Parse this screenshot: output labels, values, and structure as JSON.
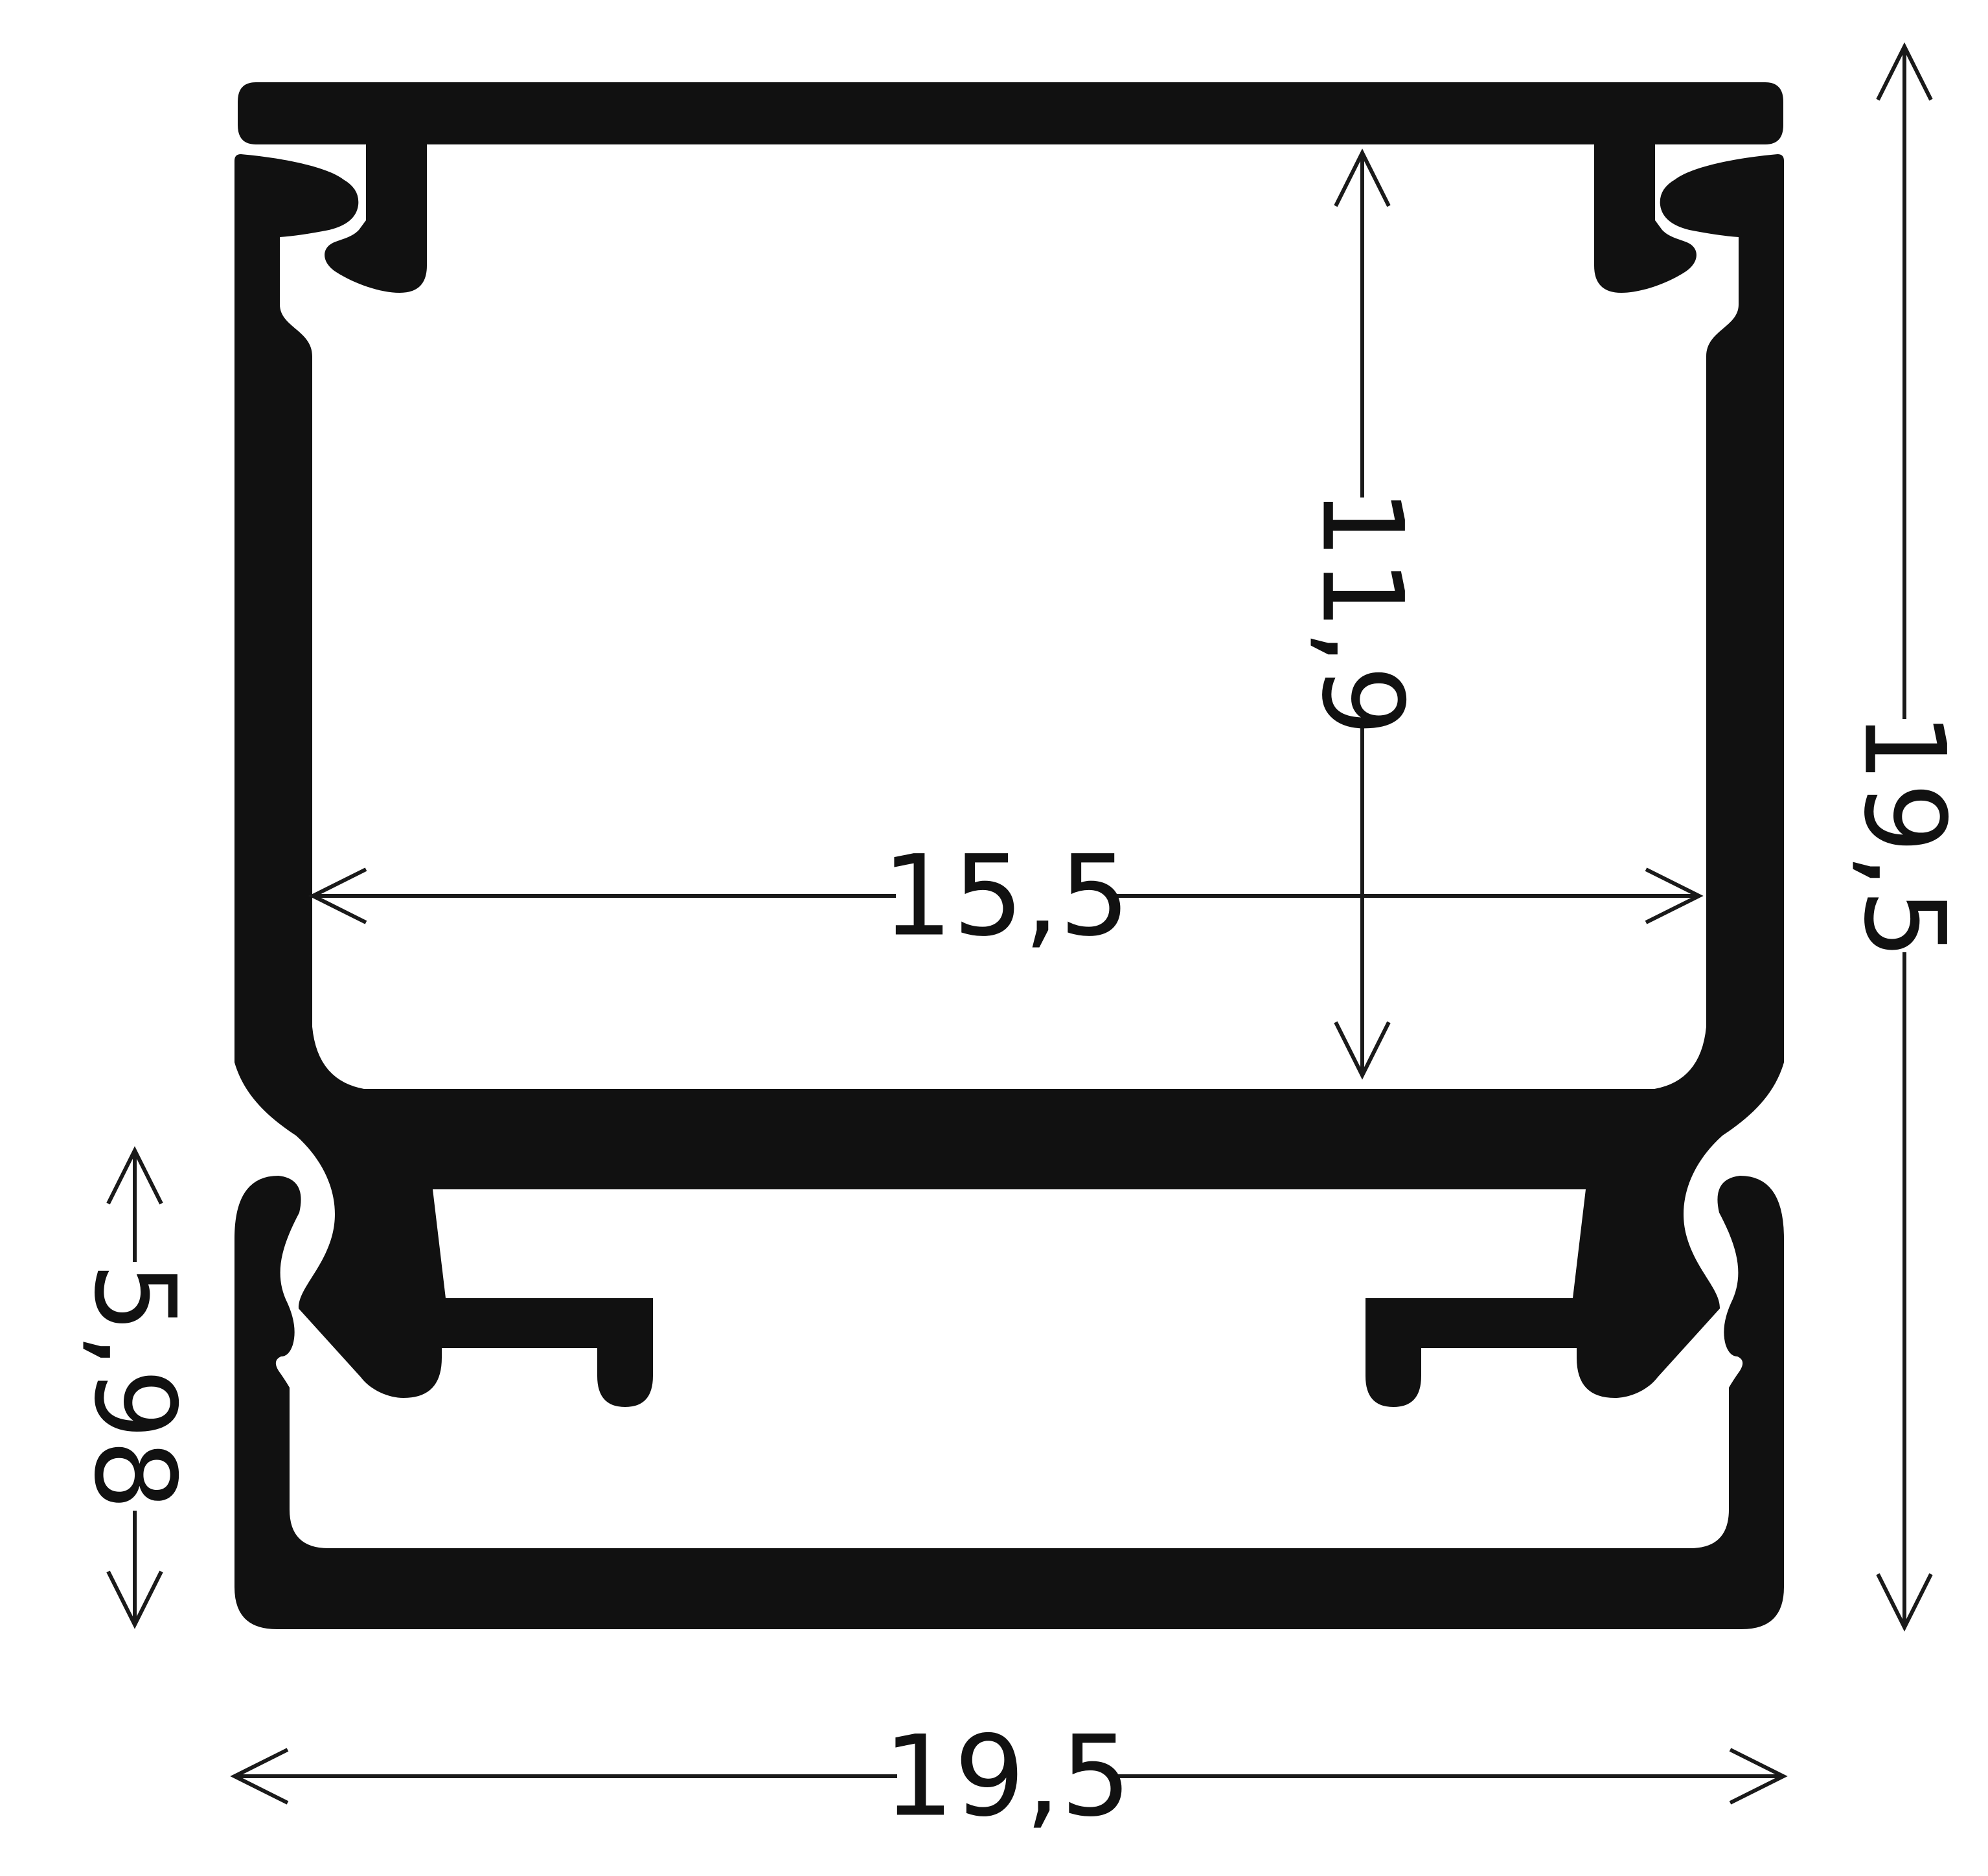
{
  "meta": {
    "background_color": "#ffffff",
    "ink_color": "#111111",
    "drawing_type": "profile-cross-section"
  },
  "dimensions": {
    "inner_height": "11,9",
    "inner_width": "15,5",
    "overall_height": "19,5",
    "base_height": "5,98",
    "overall_width": "19,5"
  }
}
